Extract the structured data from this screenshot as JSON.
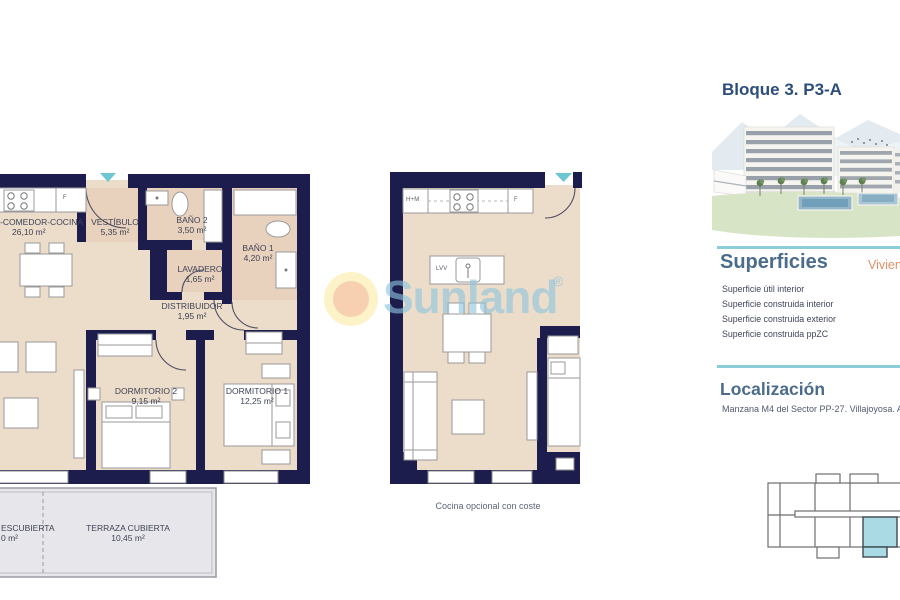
{
  "header": {
    "title": "Bloque 3. P3-A"
  },
  "watermark": {
    "brand": "Sunland",
    "reg_mark": "®"
  },
  "plan_main": {
    "rooms": [
      {
        "label": "-COMEDOR-COCINA",
        "area": "26,10 m²"
      },
      {
        "label": "VESTÍBULO",
        "area": "5,35 m²"
      },
      {
        "label": "BAÑO 2",
        "area": "3,50 m²"
      },
      {
        "label": "BAÑO 1",
        "area": "4,20 m²"
      },
      {
        "label": "LAVADERO",
        "area": "1,65 m²"
      },
      {
        "label": "DISTRIBUIDOR",
        "area": "1,95 m²"
      },
      {
        "label": "DORMITORIO 2",
        "area": "9,15 m²"
      },
      {
        "label": "DORMITORIO 1",
        "area": "12,25 m²"
      },
      {
        "label": "TERRAZA CUBIERTA",
        "area": "10,45 m²"
      },
      {
        "label": "ESCUBIERTA",
        "area": "0 m²"
      }
    ],
    "fixture_labels": {
      "fridge": "F"
    }
  },
  "plan_kitchen": {
    "fixture_labels": {
      "tall_units": "H+M",
      "fridge": "F",
      "dishwasher": "LVV"
    },
    "footnote": "Cocina opcional con coste"
  },
  "superficies": {
    "heading": "Superficies",
    "column_label": "Vivienda",
    "rows": [
      "Superficie útil interior",
      "Superficie construida interior",
      "Superficie construida exterior",
      "Superficie construida ppZC"
    ]
  },
  "localizacion": {
    "heading": "Localización",
    "text": "Manzana M4 del Sector PP-27. Villajoyosa. Alicante"
  },
  "colors": {
    "wall": "#1c1c4d",
    "floor": "#ecdcca",
    "floor_wet": "#e9d2bd",
    "terrace": "#e7e6eb",
    "accent_teal": "#8bced7",
    "entry_arrow": "#6ec6d2",
    "title_blue": "#2d4d7c",
    "section_blue": "#4b6c8a",
    "orange": "#df8f66",
    "highlight_unit": "#aadbe4",
    "watermark_blue": "#8cc3dc"
  }
}
